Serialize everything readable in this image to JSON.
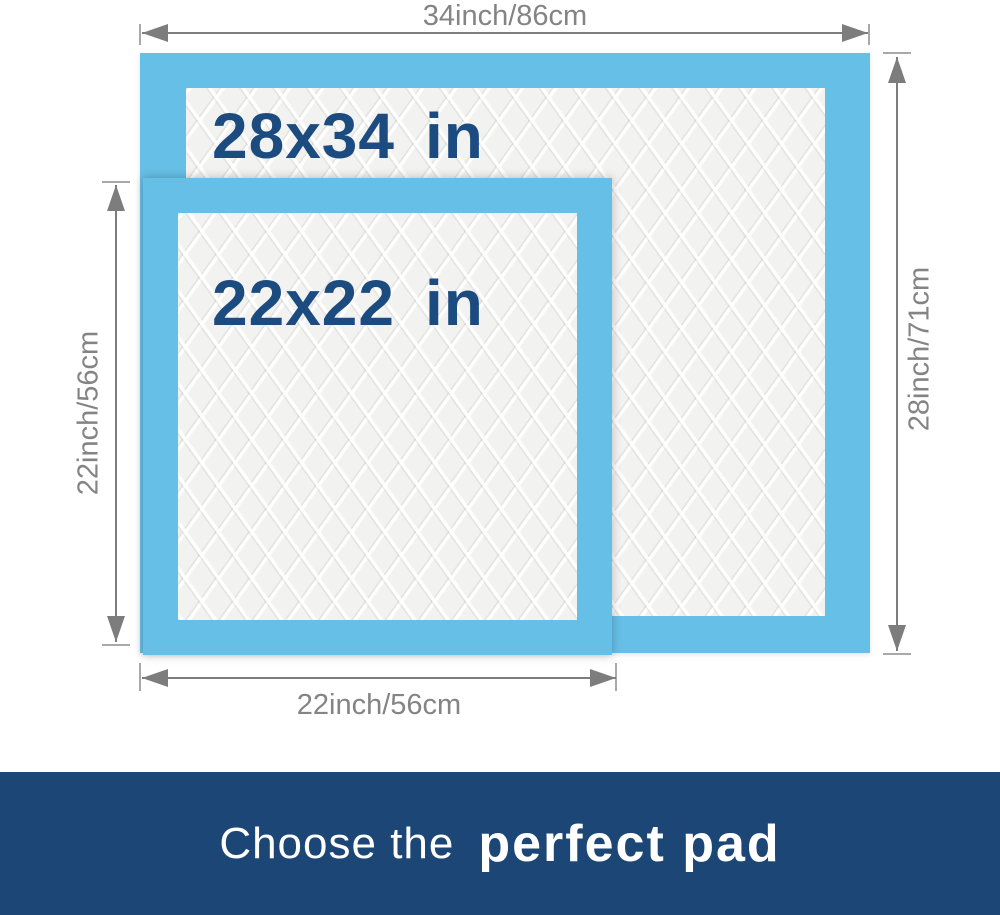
{
  "pads": {
    "large": {
      "size": "28x34",
      "unit": "in",
      "width_label": "34inch/86cm",
      "height_label": "28inch/71cm"
    },
    "small": {
      "size": "22x22",
      "unit": "in",
      "width_label": "22inch/56cm",
      "height_label": "22inch/56cm"
    }
  },
  "banner": {
    "lead": "Choose the",
    "emphasis": "perfect pad"
  },
  "colors": {
    "pad_border_blue": "#66bfe6",
    "pad_surface": "#f2f2f0",
    "size_text_navy": "#1c4b80",
    "dimension_gray": "#7d7d7d",
    "banner_background": "#1b4676",
    "banner_text": "#ffffff"
  }
}
